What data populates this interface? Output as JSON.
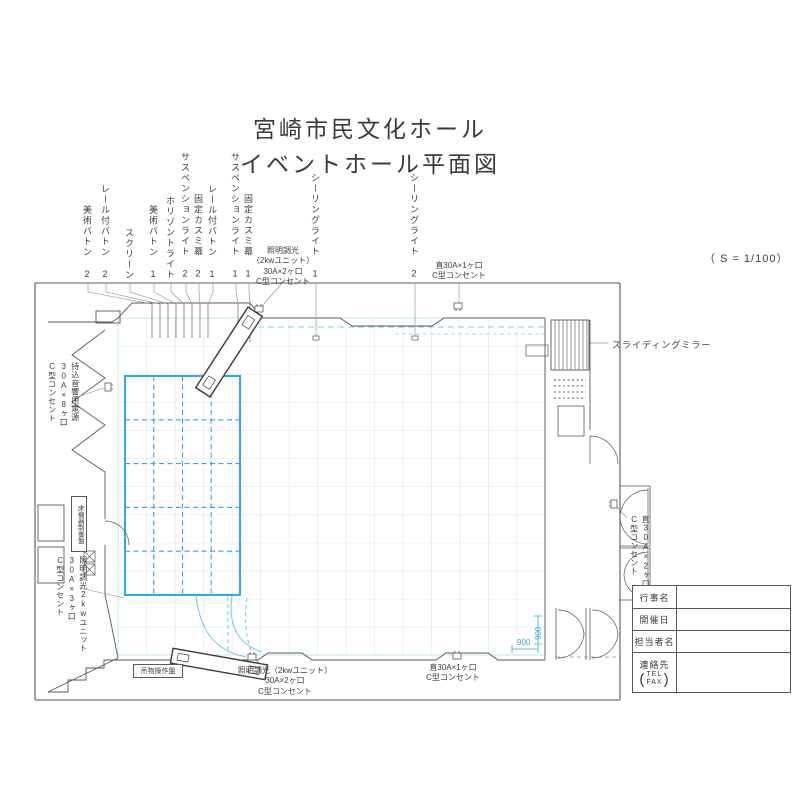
{
  "title": {
    "line1": "宮崎市民文化ホール",
    "line2": "イベントホール平面図"
  },
  "scale_note": "（ S = 1/100）",
  "batten_labels": [
    "美術バトン 2",
    "レール付バトン 2",
    "スクリーン",
    "美術バトン 1",
    "ホリゾントライト",
    "サスペンションライト 2",
    "固定カスミ幕 2",
    "レール付バトン 1",
    "サスペンションライト 1",
    "固定カスミ幕 1"
  ],
  "ceiling_labels": [
    "シーリングライト 1",
    "シーリングライト 2"
  ],
  "power_labels": {
    "top_dimmer": [
      "照明調光",
      "（2kwユニット）",
      "30A×2ヶ口",
      "C型コンセント"
    ],
    "top_direct": [
      "直30A×1ヶ口",
      "C型コンセント"
    ],
    "left_power": [
      "持込音響用電源",
      "30A×8ヶ口",
      "C型コンセント"
    ],
    "left_dimmer": [
      "照明調光2kwユニット",
      "30A×3ヶ口",
      "C型コンセント"
    ],
    "right_direct": [
      "直30A×2ヶ口",
      "C型コンセント"
    ],
    "bottom_dimmer": [
      "照明調光（2kwユニット）",
      "30A×2ヶ口",
      "C型コンセント"
    ],
    "bottom_direct": [
      "直30A×1ヶ口",
      "C型コンセント"
    ]
  },
  "annotations": {
    "sliding_mirror": "スライディングミラー",
    "floor_control_panel": "床機器制御盤",
    "rigging_control_panel": "吊物操作盤",
    "dim_vertical": "900",
    "dim_horizontal": "900"
  },
  "info_table": {
    "event_name": "行事名",
    "event_date": "開催日",
    "person_name": "担当者名",
    "contact": {
      "label": "連絡先",
      "tel": "TEL",
      "fax": "FAX"
    }
  },
  "colors": {
    "grid": "#b9e2f2",
    "stage": "#2aabe2",
    "wall": "#595757",
    "text": "#3e3a39"
  }
}
